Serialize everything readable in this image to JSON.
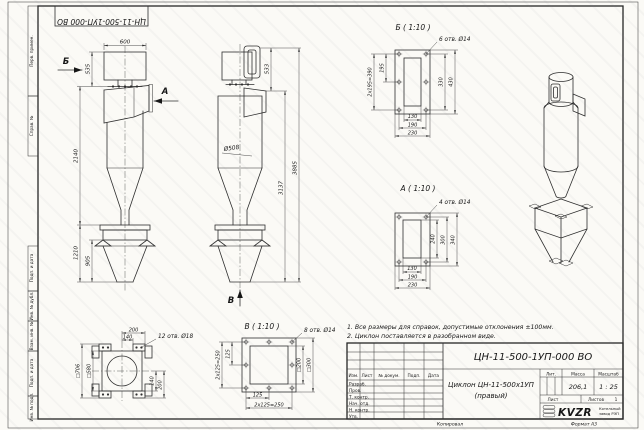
{
  "colors": {
    "paper": "#fbfaf6",
    "line": "#2e2e2e"
  },
  "frame": {
    "doc_number_top": "ЦН-11-500-1УП-000 ВО",
    "stamp": [
      "Перв. примен.",
      "Справ. №",
      "Подп. и дата",
      "Инв. № дубл.",
      "Взам. инв. №",
      "Подп. и дата",
      "Инв. № подл."
    ],
    "kopiroval": "Копировал",
    "format": "Формат А3"
  },
  "front_view": {
    "label_b": "Б",
    "label_a": "А",
    "dim_width": "600",
    "dim_535": "535",
    "dim_2140": "2140",
    "dim_1210": "1210",
    "dim_905": "905"
  },
  "side_view": {
    "label_v": "В",
    "dim_533": "533",
    "dia": "Ø508",
    "dim_3137": "3137",
    "dim_3885": "3885"
  },
  "detail_b": {
    "title": "Б ( 1:10 )",
    "holes": "6 отв. Ø14",
    "d1": "195",
    "d2": "2х195=390",
    "d3": "330",
    "d4": "430",
    "d5": "130",
    "d6": "190",
    "d7": "230"
  },
  "detail_a": {
    "title": "А ( 1:10 )",
    "holes": "4 отв. Ø14",
    "d1": "240",
    "d2": "300",
    "d3": "340",
    "d4": "130",
    "d5": "190",
    "d6": "230"
  },
  "detail_v": {
    "title": "В ( 1:10 )",
    "holes": "8 отв. Ø14",
    "d1": "125",
    "d2": "2х125=250",
    "d3": "□200",
    "d4": "□300",
    "d5": "125",
    "d6": "2х125=250"
  },
  "hopper_view": {
    "holes": "12 отв. Ø18",
    "d1": "200",
    "d2": "140",
    "d3": "□706",
    "d4": "□580",
    "d5": "140",
    "d6": "200"
  },
  "notes": [
    "1. Все размеры для справок, допустимые отклонения ±100мм.",
    "2. Циклон поставляется в разобранном виде."
  ],
  "title_block": {
    "doc_number": "ЦН-11-500-1УП-000 ВО",
    "name_line1": "Циклон ЦН-11-500х1УП",
    "name_line2": "(правый)",
    "cols": [
      "Изм.",
      "Лист",
      "№ докум.",
      "Подп.",
      "Дата"
    ],
    "rows": [
      "Разраб.",
      "Пров.",
      "Т. контр.",
      "Нач. отд.",
      "Н. контр.",
      "Утв."
    ],
    "lit": "Лит.",
    "massa_label": "Масса",
    "massa": "206,1",
    "scale_label": "Масштаб",
    "scale": "1 : 25",
    "sheet_label": "Лист",
    "sheets_label": "Листов",
    "sheets_value": "1",
    "logo": "KVZR",
    "logo_sub1": "Котельный",
    "logo_sub2": "завод РЭП"
  }
}
